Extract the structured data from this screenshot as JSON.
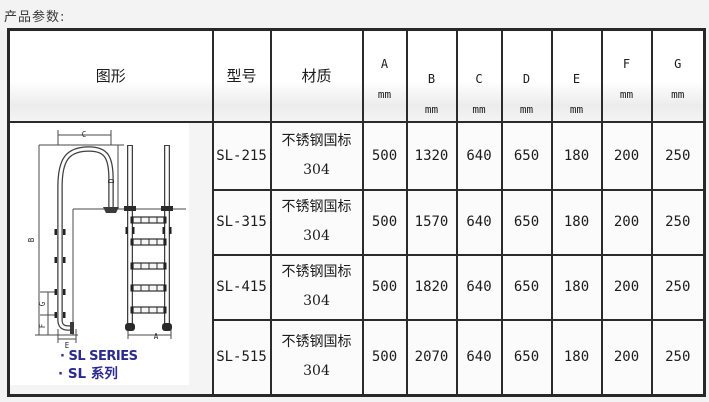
{
  "page": {
    "title": "产品参数:"
  },
  "colors": {
    "table_border": "#2b2b2b",
    "cell_bg": "#fbfbfb",
    "header_gradient_bottom": "#ececec",
    "caption_blue": "#2b2b8f",
    "drawing_line": "#454545"
  },
  "table": {
    "header": {
      "figure": "图形",
      "model": "型号",
      "material": "材质"
    },
    "dim_headers": [
      {
        "letter": "A",
        "unit": "mm"
      },
      {
        "letter": "B",
        "unit": "mm"
      },
      {
        "letter": "C",
        "unit": "mm"
      },
      {
        "letter": "D",
        "unit": "mm"
      },
      {
        "letter": "E",
        "unit": "mm"
      },
      {
        "letter": "F",
        "unit": "mm"
      },
      {
        "letter": "G",
        "unit": "mm"
      }
    ],
    "rows": [
      {
        "model": "SL-215",
        "material": [
          "不锈钢国标",
          "304"
        ],
        "values": [
          "500",
          "1320",
          "640",
          "650",
          "180",
          "200",
          "250"
        ]
      },
      {
        "model": "SL-315",
        "material": [
          "不锈钢国标",
          "304"
        ],
        "values": [
          "500",
          "1570",
          "640",
          "650",
          "180",
          "200",
          "250"
        ]
      },
      {
        "model": "SL-415",
        "material": [
          "不锈钢国标",
          "304"
        ],
        "values": [
          "500",
          "1820",
          "640",
          "650",
          "180",
          "200",
          "250"
        ]
      },
      {
        "model": "SL-515",
        "material": [
          "不锈钢国标",
          "304"
        ],
        "values": [
          "500",
          "2070",
          "640",
          "650",
          "180",
          "200",
          "250"
        ]
      }
    ]
  },
  "figure": {
    "caption_en": "· SL SERIES",
    "caption_cn": "· SL 系列",
    "labels": {
      "A": "A",
      "B": "B",
      "C": "C",
      "D": "D",
      "E": "E",
      "F": "F",
      "G": "G"
    }
  }
}
